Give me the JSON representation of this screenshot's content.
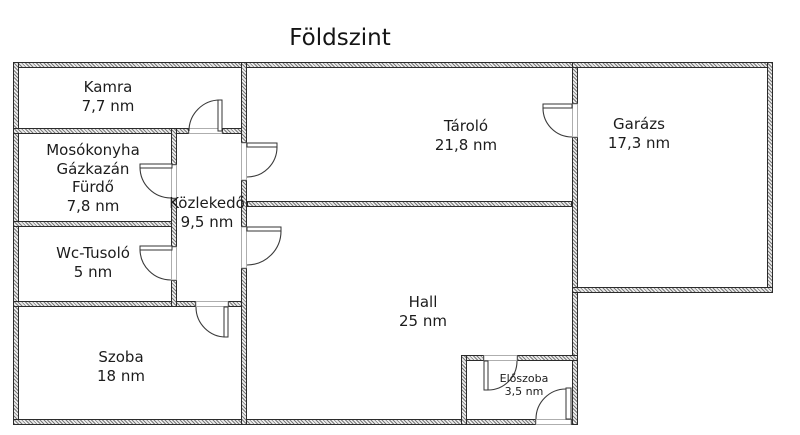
{
  "title": "Földszint",
  "unit": "nm",
  "rooms": {
    "kamra": {
      "name": "Kamra",
      "area": "7,7 nm"
    },
    "mosokonyha": {
      "name_lines": [
        "Mosókonyha",
        "Gázkazán",
        "Fürdő"
      ],
      "area": "7,8 nm"
    },
    "wc_tusolo": {
      "name": "Wc-Tusoló",
      "area": "5 nm"
    },
    "szoba": {
      "name": "Szoba",
      "area": "18 nm"
    },
    "kozlekedo": {
      "name": "Közlekedő",
      "area": "9,5 nm"
    },
    "tarolo": {
      "name": "Tároló",
      "area": "21,8 nm"
    },
    "hall": {
      "name": "Hall",
      "area": "25 nm"
    },
    "eloszoba": {
      "name": "Előszoba",
      "area": "3,5 nm"
    },
    "garazs": {
      "name": "Garázs",
      "area": "17,3 nm"
    }
  },
  "colors": {
    "background": "#ffffff",
    "wall_line": "#2b2b2b",
    "wall_hatch": "#7a7a7a",
    "text": "#1c1c1c",
    "door_line": "#3a3a3a"
  }
}
